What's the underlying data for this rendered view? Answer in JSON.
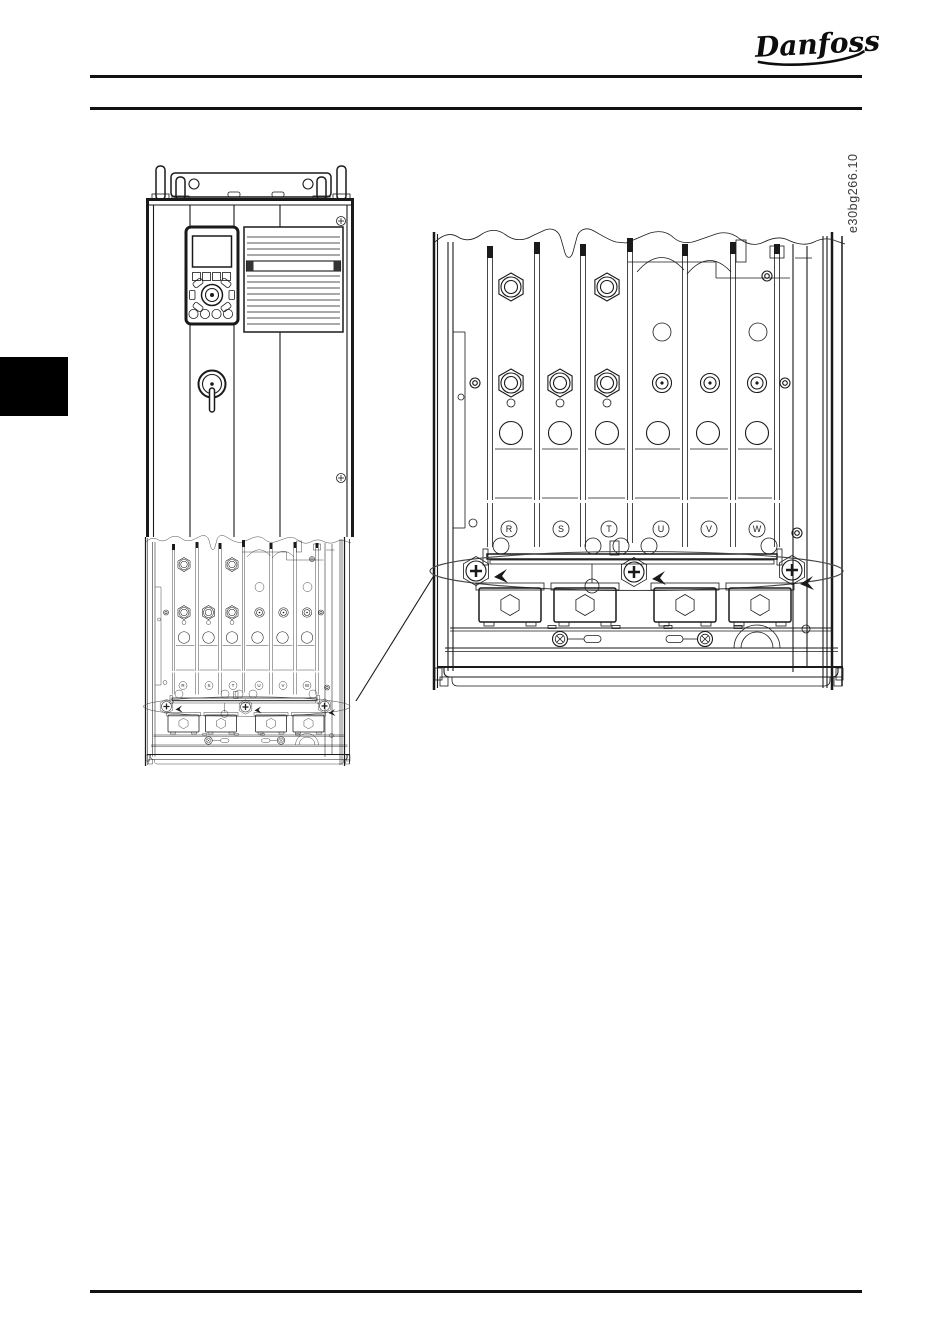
{
  "page": {
    "background": "#ffffff",
    "ink_color": "#1a1a1a"
  },
  "header": {
    "logo_text": "Danfoss"
  },
  "figure": {
    "code": "e30bg266.10",
    "terminals": [
      "R",
      "S",
      "T",
      "U",
      "V",
      "W"
    ]
  }
}
